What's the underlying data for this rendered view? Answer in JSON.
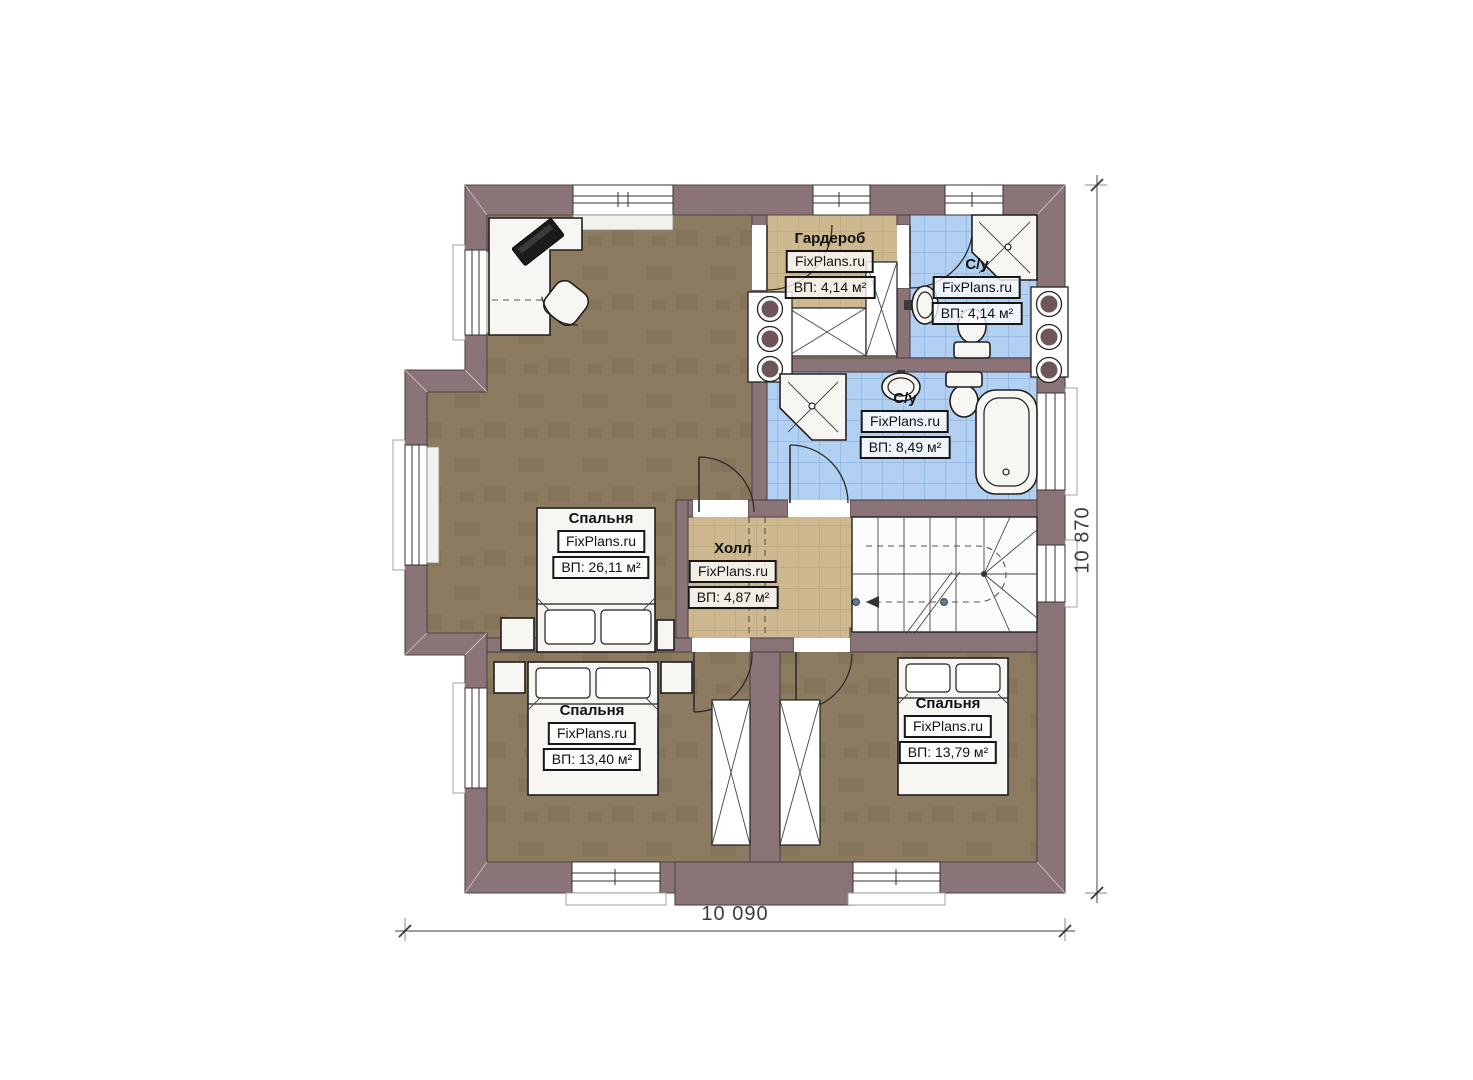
{
  "rooms": [
    {
      "id": "bedroom-master",
      "name": "Спальня",
      "brand": "FixPlans.ru",
      "area": "ВП: 26,11 м²"
    },
    {
      "id": "wardrobe",
      "name": "Гардероб",
      "brand": "FixPlans.ru",
      "area": "ВП: 4,14 м²"
    },
    {
      "id": "bathroom-top",
      "name": "С/у",
      "brand": "FixPlans.ru",
      "area": "ВП: 4,14 м²"
    },
    {
      "id": "bathroom-main",
      "name": "С/у",
      "brand": "FixPlans.ru",
      "area": "ВП: 8,49 м²"
    },
    {
      "id": "hall",
      "name": "Холл",
      "brand": "FixPlans.ru",
      "area": "ВП: 4,87 м²"
    },
    {
      "id": "bedroom-left",
      "name": "Спальня",
      "brand": "FixPlans.ru",
      "area": "ВП: 13,40 м²"
    },
    {
      "id": "bedroom-right",
      "name": "Спальня",
      "brand": "FixPlans.ru",
      "area": "ВП: 13,79 м²"
    }
  ],
  "dimensions": {
    "width": "10 090",
    "height": "10 870"
  },
  "colors": {
    "wall": "#8a7478",
    "wall_line": "#4f4347",
    "floor_wood": "#8c7b60",
    "tile_beige": "#cdb88f",
    "tile_beige_line": "#b49d71",
    "tile_blue": "#b2d0f1",
    "tile_blue_line": "#7fa9dc",
    "fixture": "#f7f6f3",
    "outline": "#1f1f1f",
    "flue": "#6d5558"
  }
}
